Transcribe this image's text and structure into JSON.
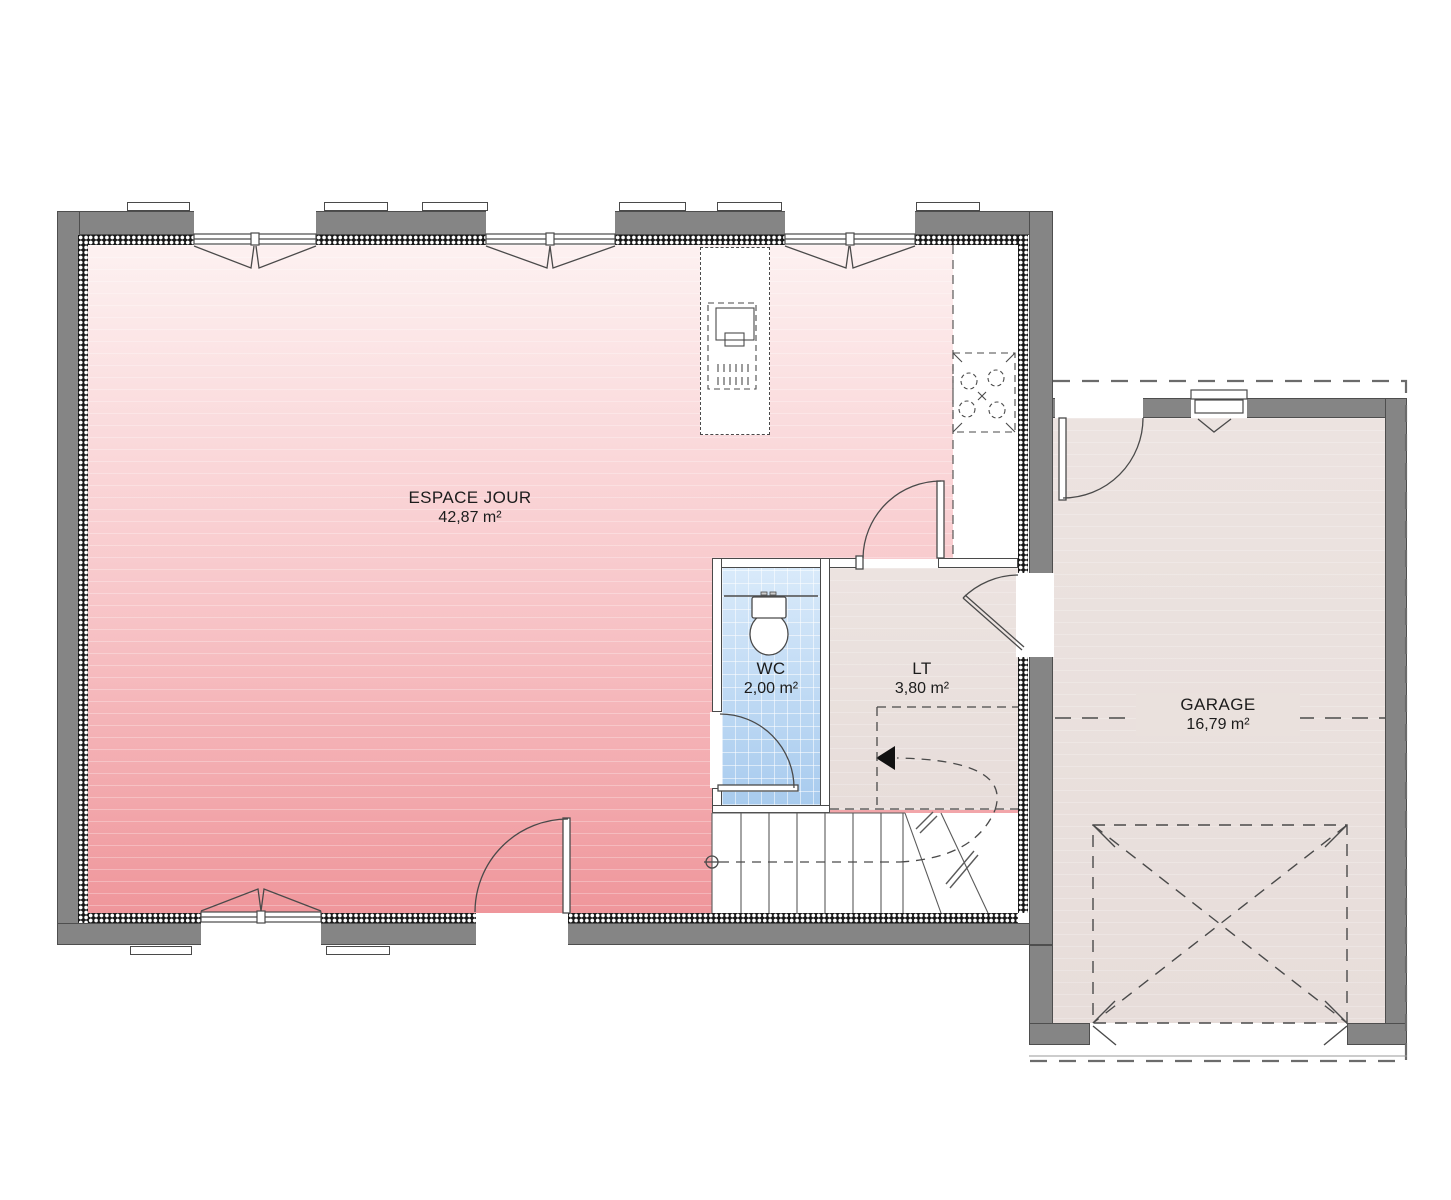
{
  "rooms": [
    {
      "id": "espace-jour",
      "name": "ESPACE JOUR",
      "area": "42,87 m²"
    },
    {
      "id": "wc",
      "name": "WC",
      "area": "2,00 m²"
    },
    {
      "id": "lt",
      "name": "LT",
      "area": "3,80 m²"
    },
    {
      "id": "garage",
      "name": "GARAGE",
      "area": "16,79 m²"
    }
  ],
  "colors": {
    "wall_gray": "#858585",
    "line_dark": "#4a4a4a",
    "floor_pink_top": "#fdf1f1",
    "floor_pink_bottom": "#ef969b",
    "floor_beige": "#ebe2df",
    "wc_tile_blue": "#a8cbee",
    "background": "#ffffff"
  }
}
